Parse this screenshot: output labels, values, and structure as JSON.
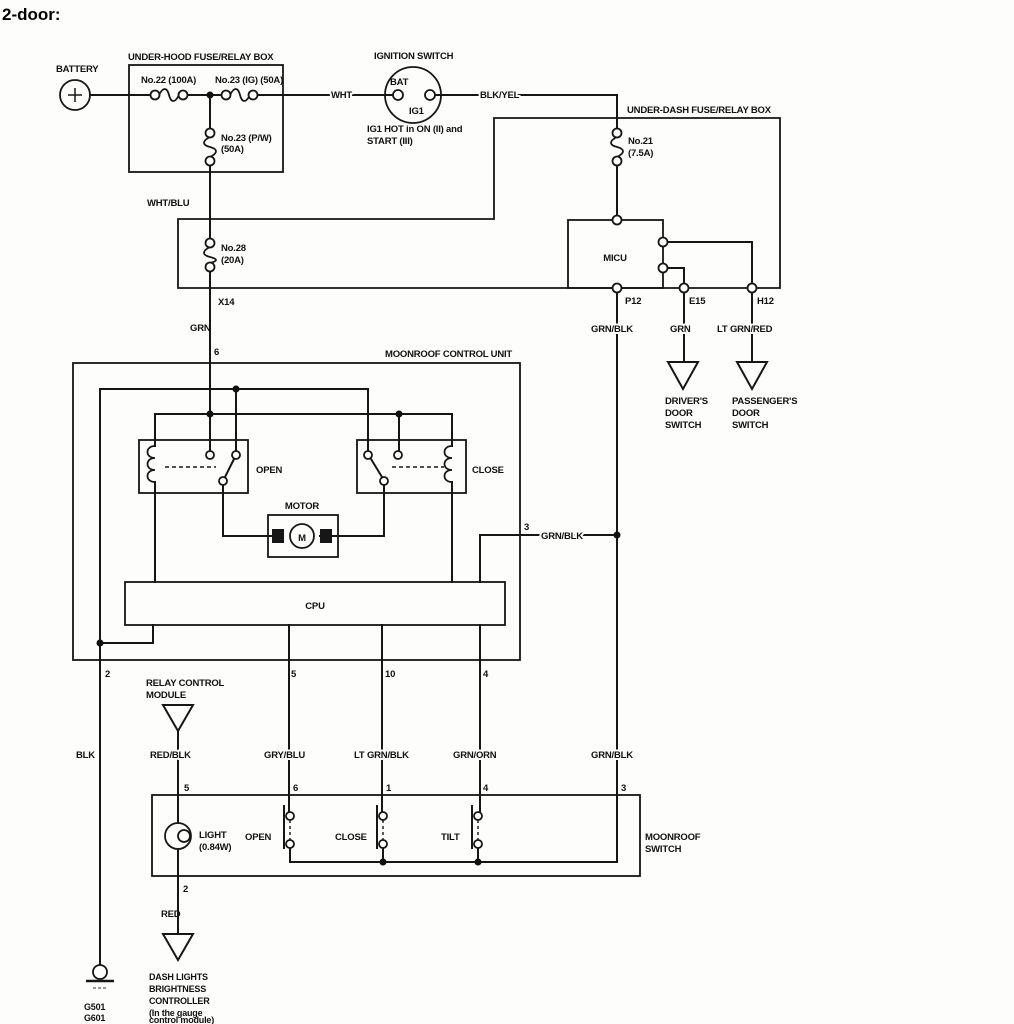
{
  "title": "2-door:",
  "battery": {
    "label": "BATTERY"
  },
  "under_hood": {
    "title": "UNDER-HOOD FUSE/RELAY BOX",
    "fuse_22": "No.22 (100A)",
    "fuse_23_ig": "No.23 (IG) (50A)",
    "fuse_23_pw": [
      "No.23 (P/W)",
      "(50A)"
    ]
  },
  "ignition": {
    "title": "IGNITION SWITCH",
    "bat": "BAT",
    "ig1": "IG1",
    "note": [
      "IG1 HOT in ON (II) and",
      "START (III)"
    ]
  },
  "under_dash": {
    "title": "UNDER-DASH FUSE/RELAY BOX",
    "fuse_21": [
      "No.21",
      "(7.5A)"
    ],
    "fuse_28": [
      "No.28",
      "(20A)"
    ],
    "micu": "MICU",
    "x14": "X14",
    "p12": "P12",
    "e15": "E15",
    "h12": "H12"
  },
  "wires": {
    "wht": "WHT",
    "blk_yel": "BLK/YEL",
    "wht_blu": "WHT/BLU",
    "grn_6": "GRN",
    "grn_blk_p12": "GRN/BLK",
    "grn_e15": "GRN",
    "lt_grn_red": "LT GRN/RED",
    "grn_blk_3": "GRN/BLK",
    "blk": "BLK",
    "red_blk": "RED/BLK",
    "gry_blu": "GRY/BLU",
    "lt_grn_blk": "LT GRN/BLK",
    "grn_orn": "GRN/ORN",
    "grn_blk_sw": "GRN/BLK",
    "red": "RED"
  },
  "pins": {
    "cu_6": "6",
    "cu_3": "3",
    "cu_2": "2",
    "cu_5": "5",
    "cu_10": "10",
    "cu_4": "4",
    "sw_5": "5",
    "sw_6": "6",
    "sw_1": "1",
    "sw_4": "4",
    "sw_3": "3",
    "sw_2": "2"
  },
  "control_unit": {
    "title": "MOONROOF CONTROL UNIT",
    "open": "OPEN",
    "close": "CLOSE",
    "motor": "MOTOR",
    "m": "M",
    "cpu": "CPU"
  },
  "door_switches": {
    "driver": [
      "DRIVER'S",
      "DOOR",
      "SWITCH"
    ],
    "passenger": [
      "PASSENGER'S",
      "DOOR",
      "SWITCH"
    ]
  },
  "relay_module": [
    "RELAY CONTROL",
    "MODULE"
  ],
  "moonroof_switch": {
    "label": [
      "MOONROOF",
      "SWITCH"
    ],
    "light": [
      "LIGHT",
      "(0.84W)"
    ],
    "open": "OPEN",
    "close": "CLOSE",
    "tilt": "TILT"
  },
  "dash_controller": [
    "DASH LIGHTS",
    "BRIGHTNESS",
    "CONTROLLER",
    "(In the gauge",
    "control module)"
  ],
  "grounds": [
    "G501",
    "G601"
  ],
  "colors": {
    "line": "#161616",
    "background": "#fdfdfc"
  }
}
